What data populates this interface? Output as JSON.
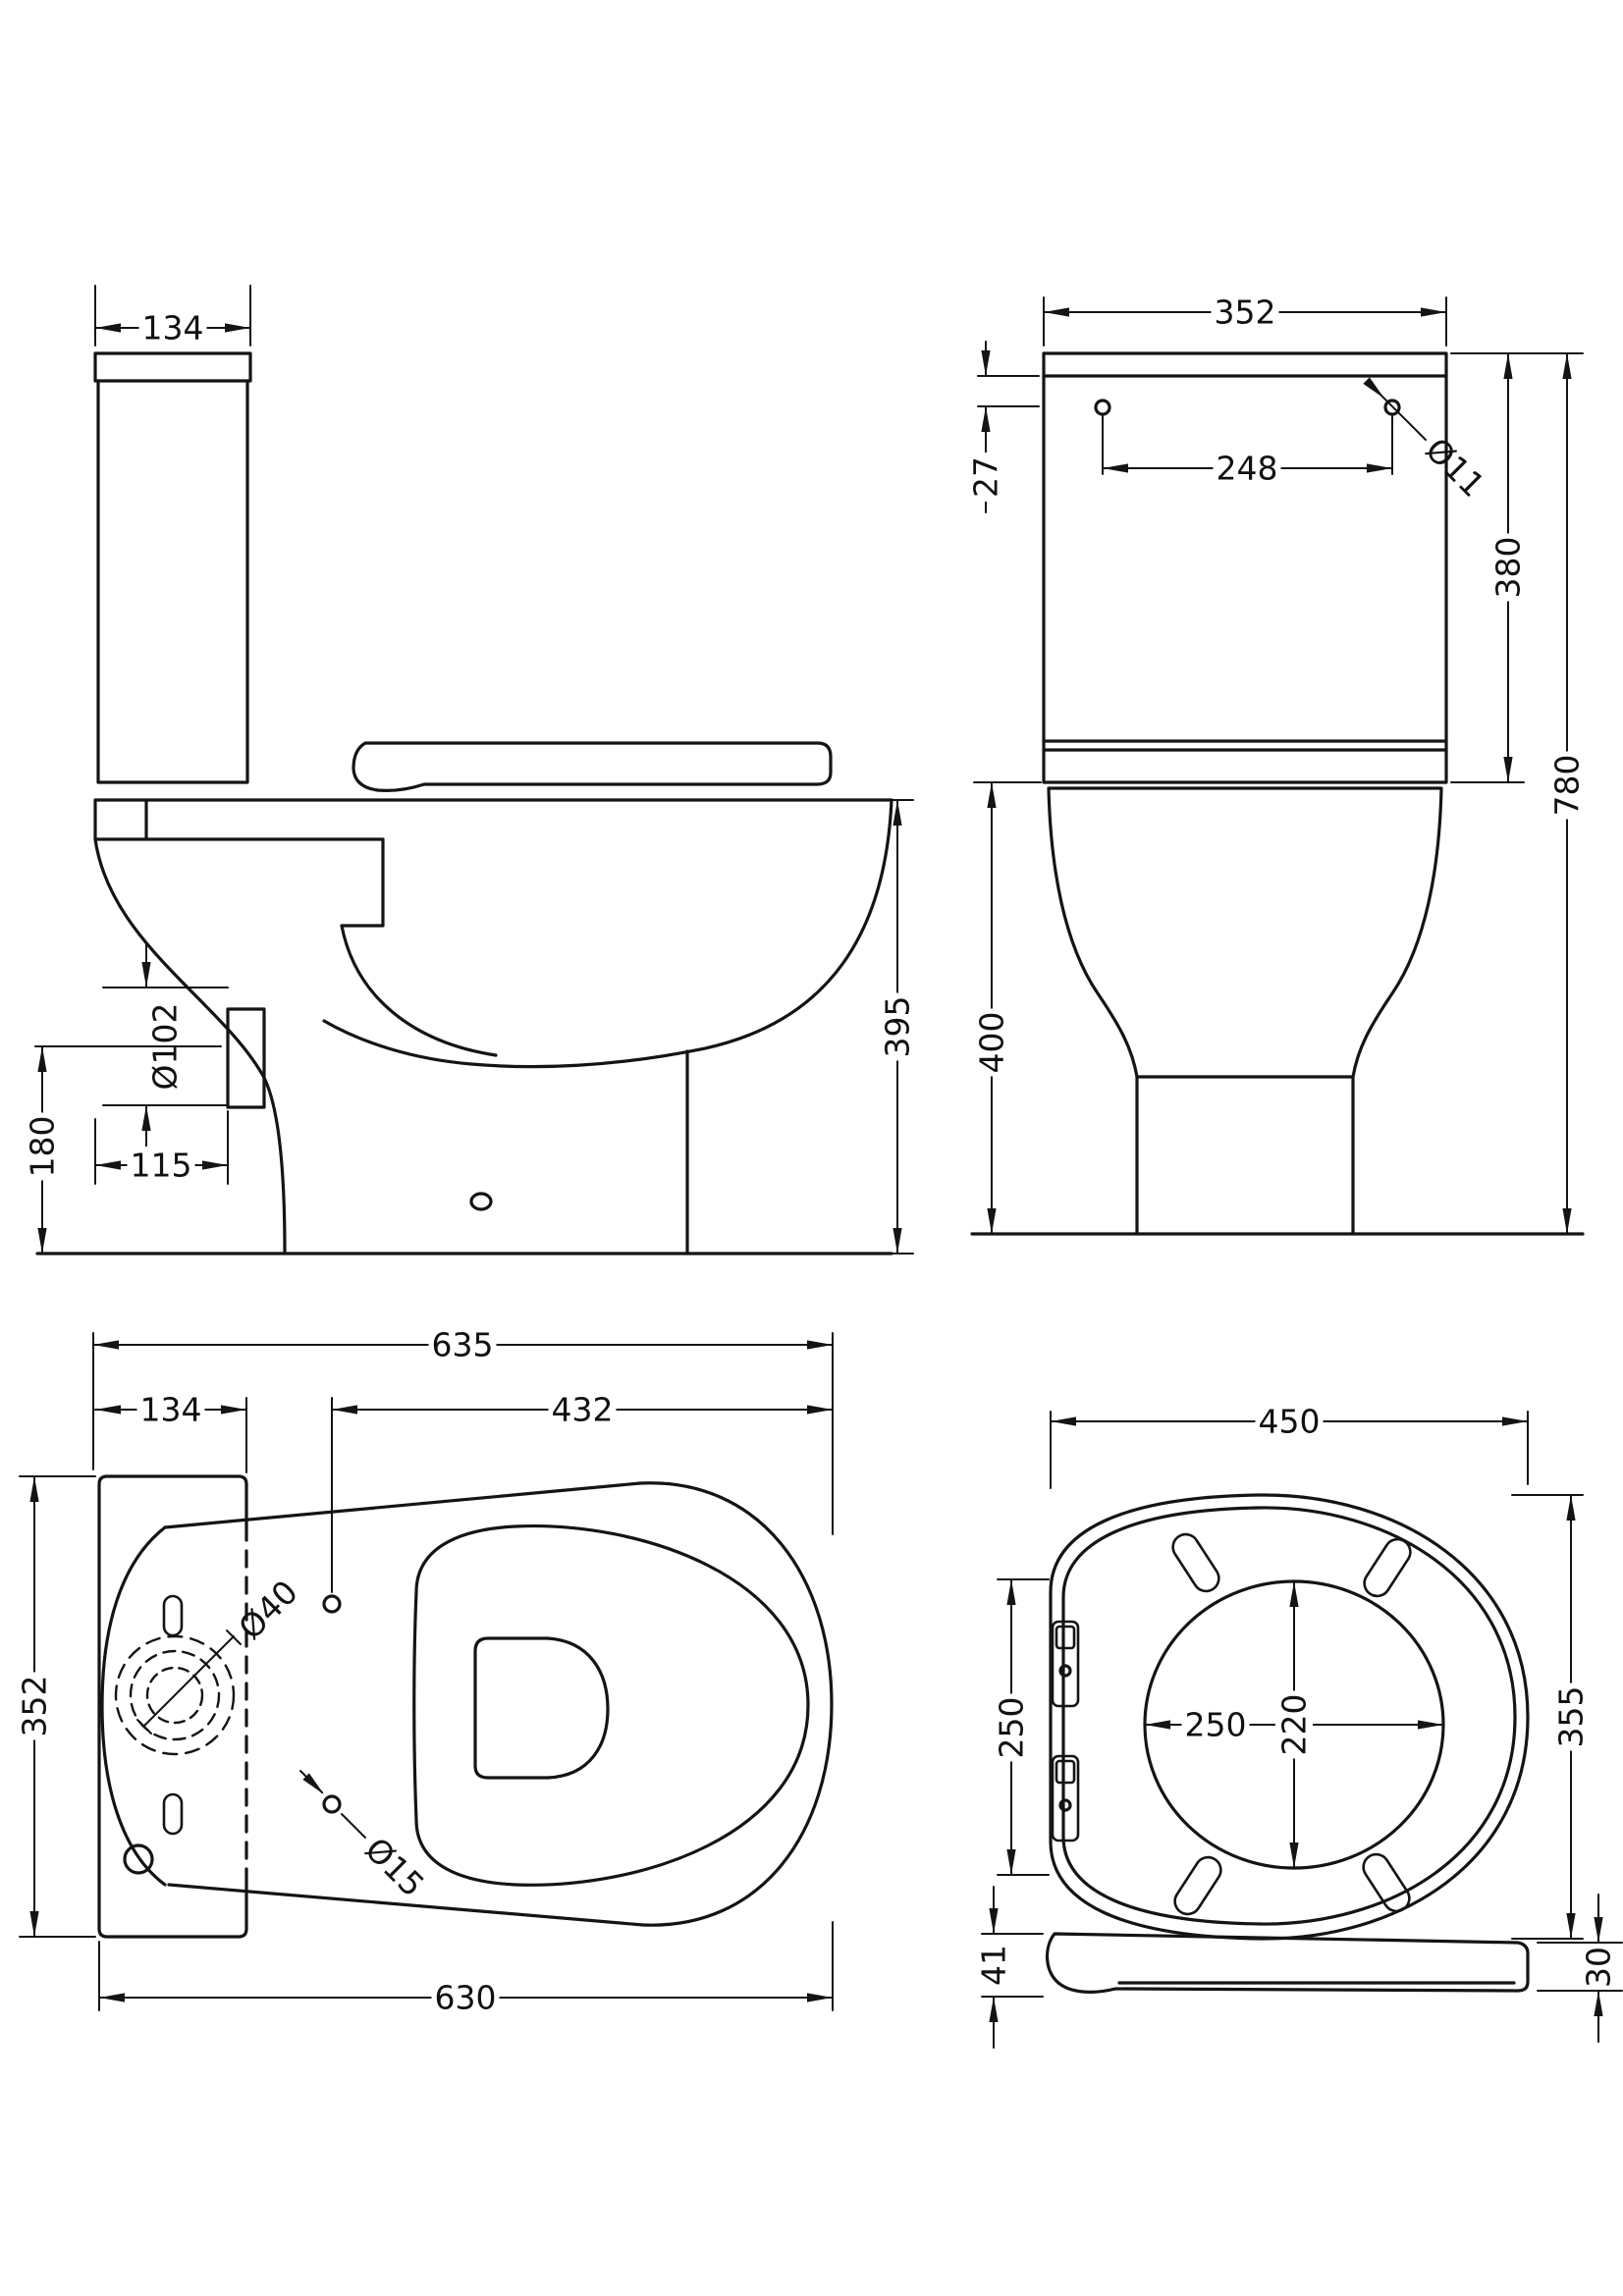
{
  "document": {
    "type": "technical-drawing",
    "subject": "Close coupled toilet (cistern, pan and seat) dimensioned orthographic views",
    "units": "mm"
  },
  "colors": {
    "line": "#141414",
    "background": "#ffffff"
  },
  "views": {
    "side_elevation": {
      "title": "side elevation",
      "dimensions": {
        "cistern_depth": "134",
        "height_to_seat": "395",
        "outlet_height": "180",
        "outlet_diameter": "Ø102",
        "outlet_setout": "115"
      }
    },
    "front_elevation": {
      "title": "front elevation",
      "dimensions": {
        "cistern_width": "352",
        "lid_to_holes": "27",
        "hole_spacing": "248",
        "hole_diameter": "Ø11",
        "cistern_height": "380",
        "overall_height": "780",
        "bowl_height": "400"
      }
    },
    "plan": {
      "title": "plan",
      "dimensions": {
        "overall_depth": "635",
        "cistern_depth": "134",
        "seat_length": "432",
        "footprint_width": "352",
        "flush_inlet_diameter": "Ø40",
        "fixing_hole_diameter": "Ø15",
        "pan_depth": "630"
      }
    },
    "seat_plan": {
      "title": "seat plan",
      "dimensions": {
        "seat_width": "450",
        "hinge_span": "250",
        "opening_width": "250",
        "opening_depth": "220",
        "seat_depth": "355"
      }
    },
    "seat_profile": {
      "title": "seat profile",
      "dimensions": {
        "front_thickness": "41",
        "rear_thickness": "30"
      }
    }
  }
}
